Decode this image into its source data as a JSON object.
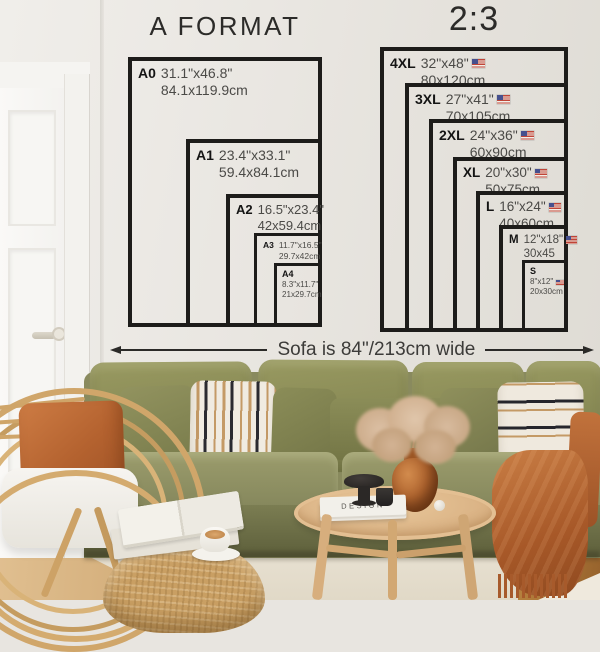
{
  "charts": [
    {
      "title": "A FORMAT",
      "sizes": [
        {
          "code": "A0",
          "inches": "31.1\"x46.8\"",
          "cm": "84.1x119.9cm",
          "flag": false
        },
        {
          "code": "A1",
          "inches": "23.4\"x33.1\"",
          "cm": "59.4x84.1cm",
          "flag": false
        },
        {
          "code": "A2",
          "inches": "16.5\"x23.4\"",
          "cm": "42x59.4cm",
          "flag": false
        },
        {
          "code": "A3",
          "inches": "11.7\"x16.5\"",
          "cm": "29.7x42cm",
          "flag": false
        },
        {
          "code": "A4",
          "inches": "8.3\"x11.7\"",
          "cm": "21x29.7cm",
          "flag": false
        }
      ]
    },
    {
      "title": "2:3",
      "sizes": [
        {
          "code": "4XL",
          "inches": "32\"x48\"",
          "cm": "80x120cm",
          "flag": true
        },
        {
          "code": "3XL",
          "inches": "27\"x41\"",
          "cm": "70x105cm",
          "flag": true
        },
        {
          "code": "2XL",
          "inches": "24\"x36\"",
          "cm": "60x90cm",
          "flag": true
        },
        {
          "code": "XL",
          "inches": "20\"x30\"",
          "cm": "50x75cm",
          "flag": true
        },
        {
          "code": "L",
          "inches": "16\"x24\"",
          "cm": "40x60cm",
          "flag": true
        },
        {
          "code": "M",
          "inches": "12\"x18\"",
          "cm": "30x45",
          "flag": true
        },
        {
          "code": "S",
          "inches": "8\"x12\"",
          "cm": "20x30cm",
          "flag": true
        }
      ]
    }
  ],
  "sofa_note": "Sofa is 84\"/213cm wide",
  "photo": {
    "book_spine": "DESIGN"
  },
  "colors": {
    "frame": "#1d1c1a",
    "label": "#141414",
    "dims": "#4b4a47",
    "title": "#2c2b29",
    "arrow": "#2b2a28",
    "note": "#3c3b39"
  }
}
